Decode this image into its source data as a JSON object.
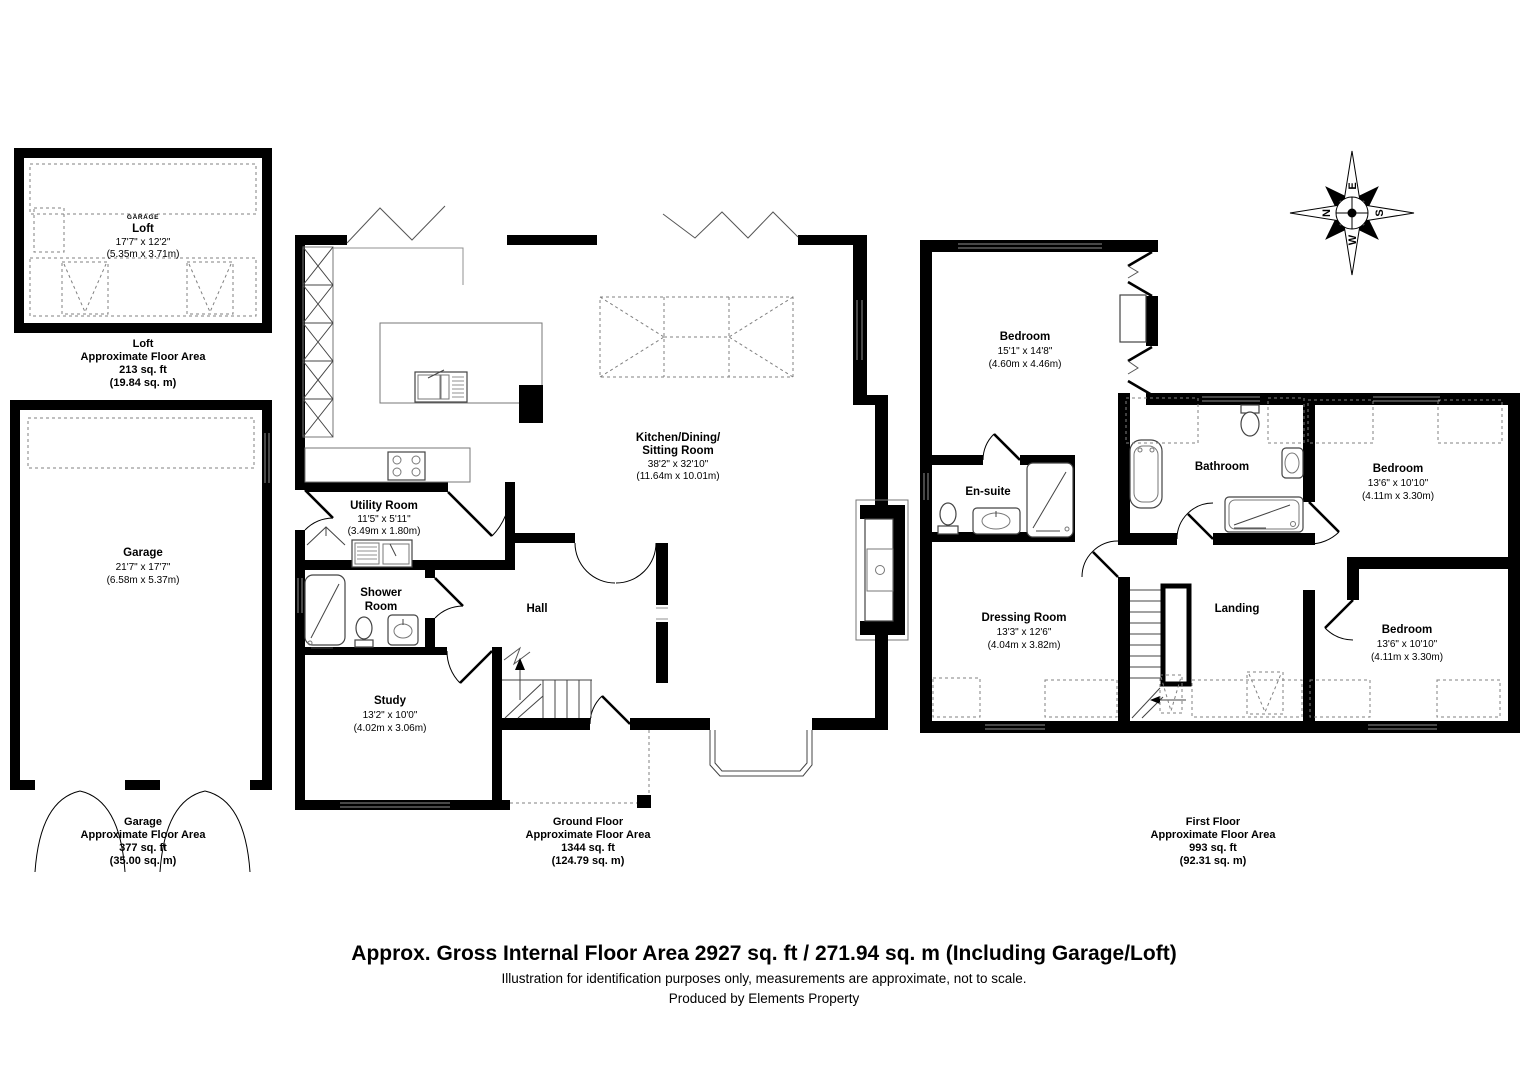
{
  "rooms": {
    "loft": {
      "tag": "GARAGE",
      "name": "Loft",
      "dims_ft": "17'7\" x 12'2\"",
      "dims_m": "(5.35m x 3.71m)"
    },
    "garage": {
      "name": "Garage",
      "dims_ft": "21'7\" x 17'7\"",
      "dims_m": "(6.58m x 5.37m)"
    },
    "kitchen": {
      "name_line1": "Kitchen/Dining/",
      "name_line2": "Sitting Room",
      "dims_ft": "38'2\" x 32'10\"",
      "dims_m": "(11.64m x 10.01m)"
    },
    "utility": {
      "name": "Utility Room",
      "dims_ft": "11'5\" x 5'11\"",
      "dims_m": "(3.49m x 1.80m)"
    },
    "shower": {
      "name_line1": "Shower",
      "name_line2": "Room"
    },
    "hall": {
      "name": "Hall"
    },
    "study": {
      "name": "Study",
      "dims_ft": "13'2\" x 10'0\"",
      "dims_m": "(4.02m x 3.06m)"
    },
    "bedroom1": {
      "name": "Bedroom",
      "dims_ft": "15'1\" x 14'8\"",
      "dims_m": "(4.60m x 4.46m)"
    },
    "ensuite": {
      "name": "En-suite"
    },
    "bathroom": {
      "name": "Bathroom"
    },
    "bedroom2": {
      "name": "Bedroom",
      "dims_ft": "13'6\" x 10'10\"",
      "dims_m": "(4.11m x 3.30m)"
    },
    "bedroom3": {
      "name": "Bedroom",
      "dims_ft": "13'6\" x 10'10\"",
      "dims_m": "(4.11m x 3.30m)"
    },
    "dressing": {
      "name": "Dressing Room",
      "dims_ft": "13'3\" x 12'6\"",
      "dims_m": "(4.04m x 3.82m)"
    },
    "landing": {
      "name": "Landing"
    }
  },
  "captions": {
    "loft": {
      "line1": "Loft",
      "line2": "Approximate Floor Area",
      "line3": "213 sq. ft",
      "line4": "(19.84 sq. m)"
    },
    "garage": {
      "line1": "Garage",
      "line2": "Approximate Floor Area",
      "line3": "377 sq. ft",
      "line4": "(35.00 sq. m)"
    },
    "ground": {
      "line1": "Ground Floor",
      "line2": "Approximate Floor Area",
      "line3": "1344 sq. ft",
      "line4": "(124.79 sq. m)"
    },
    "first": {
      "line1": "First Floor",
      "line2": "Approximate Floor Area",
      "line3": "993 sq. ft",
      "line4": "(92.31 sq. m)"
    }
  },
  "footer": {
    "line1": "Approx. Gross Internal Floor Area 2927 sq. ft / 271.94 sq. m (Including Garage/Loft)",
    "line2": "Illustration for identification purposes only, measurements are approximate, not to scale.",
    "line3": "Produced by Elements Property"
  },
  "compass": {
    "n": "N",
    "e": "E",
    "s": "S",
    "w": "W"
  },
  "colors": {
    "wall": "#000000",
    "thin_line": "#444444",
    "dashed_line": "#808080",
    "background": "#ffffff"
  }
}
